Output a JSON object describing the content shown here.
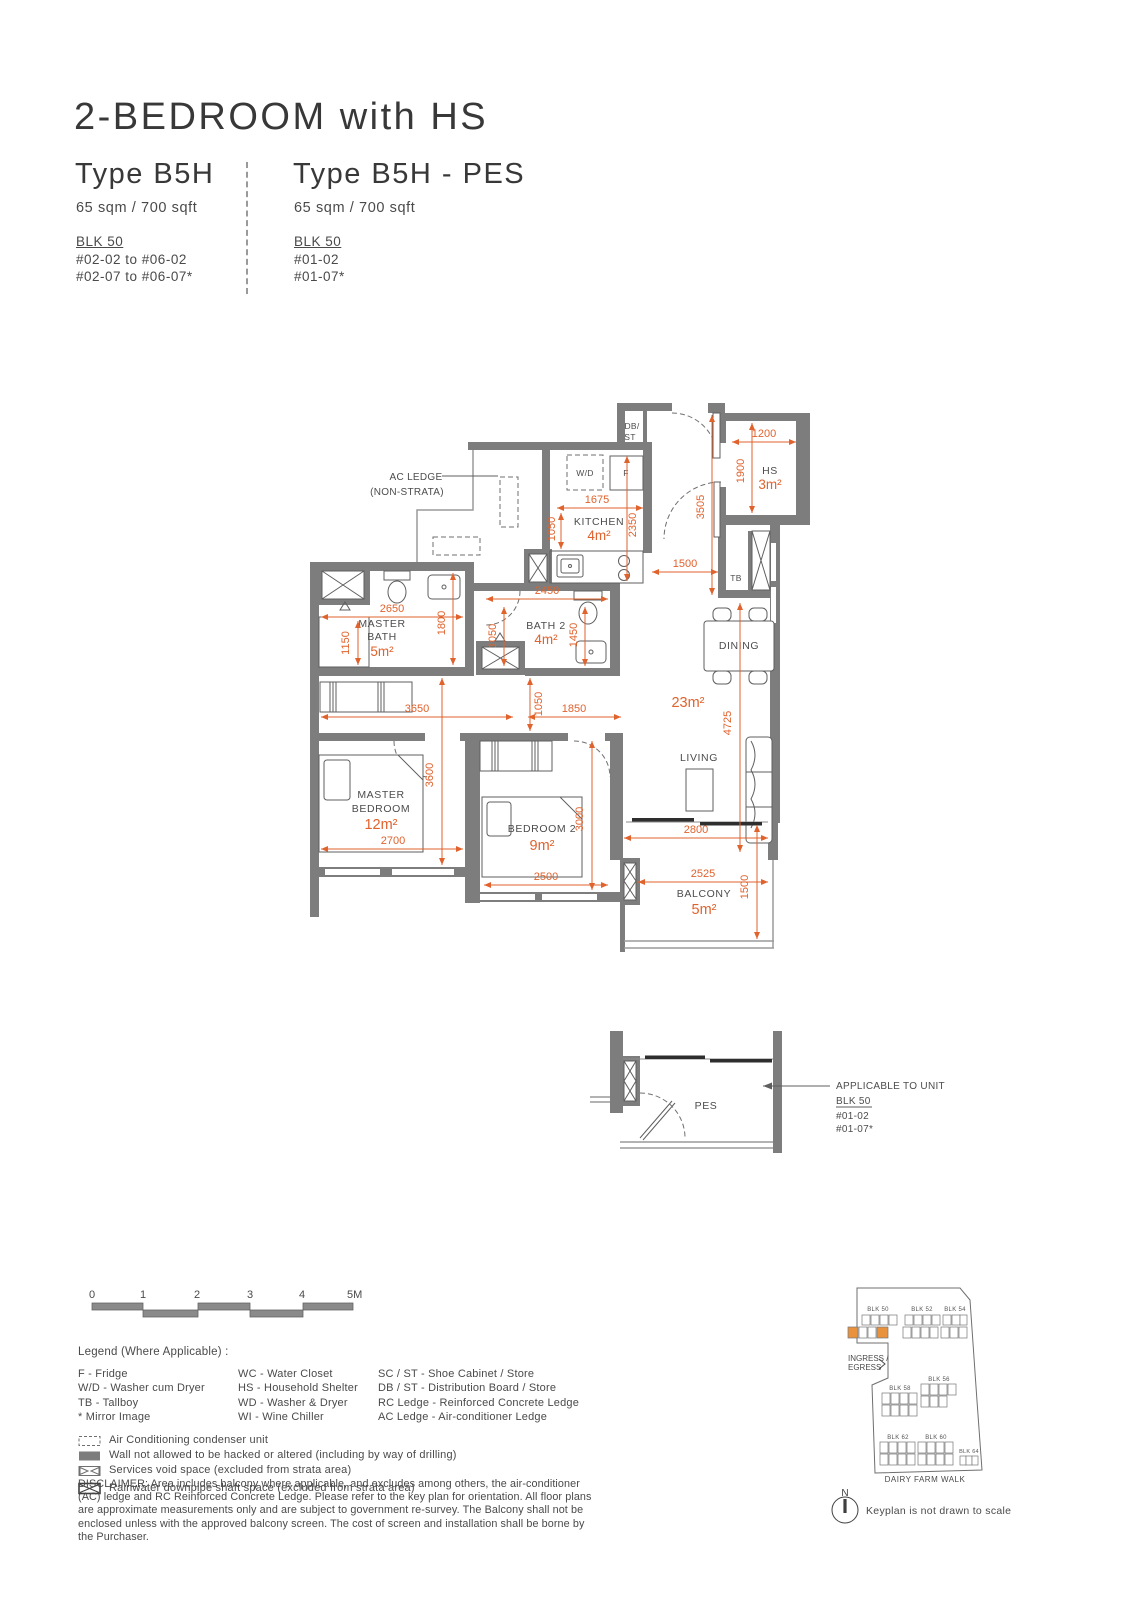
{
  "header": {
    "title": "2-BEDROOM with HS",
    "variants": [
      {
        "name": "Type B5H",
        "area": "65 sqm / 700 sqft",
        "block": "BLK 50",
        "units": [
          "#02-02 to #06-02",
          "#02-07 to #06-07*"
        ]
      },
      {
        "name": "Type B5H - PES",
        "area": "65 sqm / 700 sqft",
        "block": "BLK 50",
        "units": [
          "#01-02",
          "#01-07*"
        ]
      }
    ]
  },
  "floorplan": {
    "callouts": {
      "ac1": "AC LEDGE",
      "ac2": "(NON-STRATA)"
    },
    "rooms": {
      "dbst1": "DB/",
      "dbst2": "ST",
      "wd": "W/D",
      "fridge": "F",
      "tb": "TB",
      "hs": "HS",
      "hs_area": "3m²",
      "kitchen": "KITCHEN",
      "kitchen_area": "4m²",
      "mbath1": "MASTER",
      "mbath2": "BATH",
      "mbath_area": "5m²",
      "bath2": "BATH 2",
      "bath2_area": "4m²",
      "dining": "DINING",
      "living": "LIVING",
      "ld_area": "23m²",
      "mbr1": "MASTER",
      "mbr2": "BEDROOM",
      "mbr_area": "12m²",
      "br2": "BEDROOM 2",
      "br2_area": "9m²",
      "balcony": "BALCONY",
      "balcony_area": "5m²"
    },
    "dims": {
      "k_w": "1675",
      "k_d": "1050",
      "k_d2": "2350",
      "hs_w": "1200",
      "hs_d": "1900",
      "entry_d": "3505",
      "foyer_w": "1500",
      "mb_w": "2650",
      "mb_d": "1800",
      "mb_d2": "1150",
      "b2_w": "2450",
      "b2_d": "1050",
      "b2_d2": "1450",
      "hall_w": "3650",
      "hall_d": "1050",
      "hall_w2": "1850",
      "ld_d": "4725",
      "mbr_w": "2700",
      "mbr_d": "3600",
      "br2_w": "2500",
      "br2_d": "3000",
      "lv_w": "2800",
      "bal_w": "2525",
      "bal_d": "1500"
    }
  },
  "pes": {
    "room": "PES",
    "callout": [
      "APPLICABLE TO UNIT",
      "BLK 50",
      "#01-02",
      "#01-07*"
    ]
  },
  "scalebar": {
    "ticks": [
      "0",
      "1",
      "2",
      "3",
      "4",
      "5M"
    ]
  },
  "legend": {
    "title": "Legend (Where Applicable) :",
    "col1": [
      "F - Fridge",
      "W/D - Washer cum Dryer",
      "TB - Tallboy",
      "* Mirror Image"
    ],
    "col2": [
      "WC - Water Closet",
      "HS - Household Shelter",
      "WD - Washer & Dryer",
      "WI - Wine Chiller"
    ],
    "col3": [
      "SC / ST - Shoe Cabinet / Store",
      "DB / ST - Distribution Board / Store",
      "RC Ledge - Reinforced Concrete Ledge",
      "AC Ledge - Air-conditioner Ledge"
    ],
    "symbols": [
      "Air Conditioning condenser unit",
      "Wall not allowed to be hacked or altered (including by way of drilling)",
      "Services void space (excluded from strata area)",
      "Rainwater downpipe shaft space (excluded from strata area)"
    ]
  },
  "disclaimer": "DISCLAIMER: Area includes balcony where applicable, and excludes among others, the air-conditioner (AC) ledge and RC Reinforced Concrete Ledge. Please refer to the key plan for orientation. All floor plans are approximate measurements only and are subject to government re-survey. The Balcony shall not be enclosed unless with the approved balcony screen. The cost of screen and installation shall be borne by the Purchaser.",
  "keyplan": {
    "blocks": [
      "BLK 50",
      "BLK 52",
      "BLK 54",
      "BLK 58",
      "BLK 56",
      "BLK 62",
      "BLK 60",
      "BLK 64"
    ],
    "ingress1": "INGRESS /",
    "ingress2": "EGRESS",
    "road": "DAIRY FARM WALK",
    "north": "N",
    "note": "Keyplan is not drawn to scale"
  },
  "colors": {
    "accent": "#E0622D",
    "wall": "#7d7d7d",
    "highlight": "#E8923E"
  }
}
